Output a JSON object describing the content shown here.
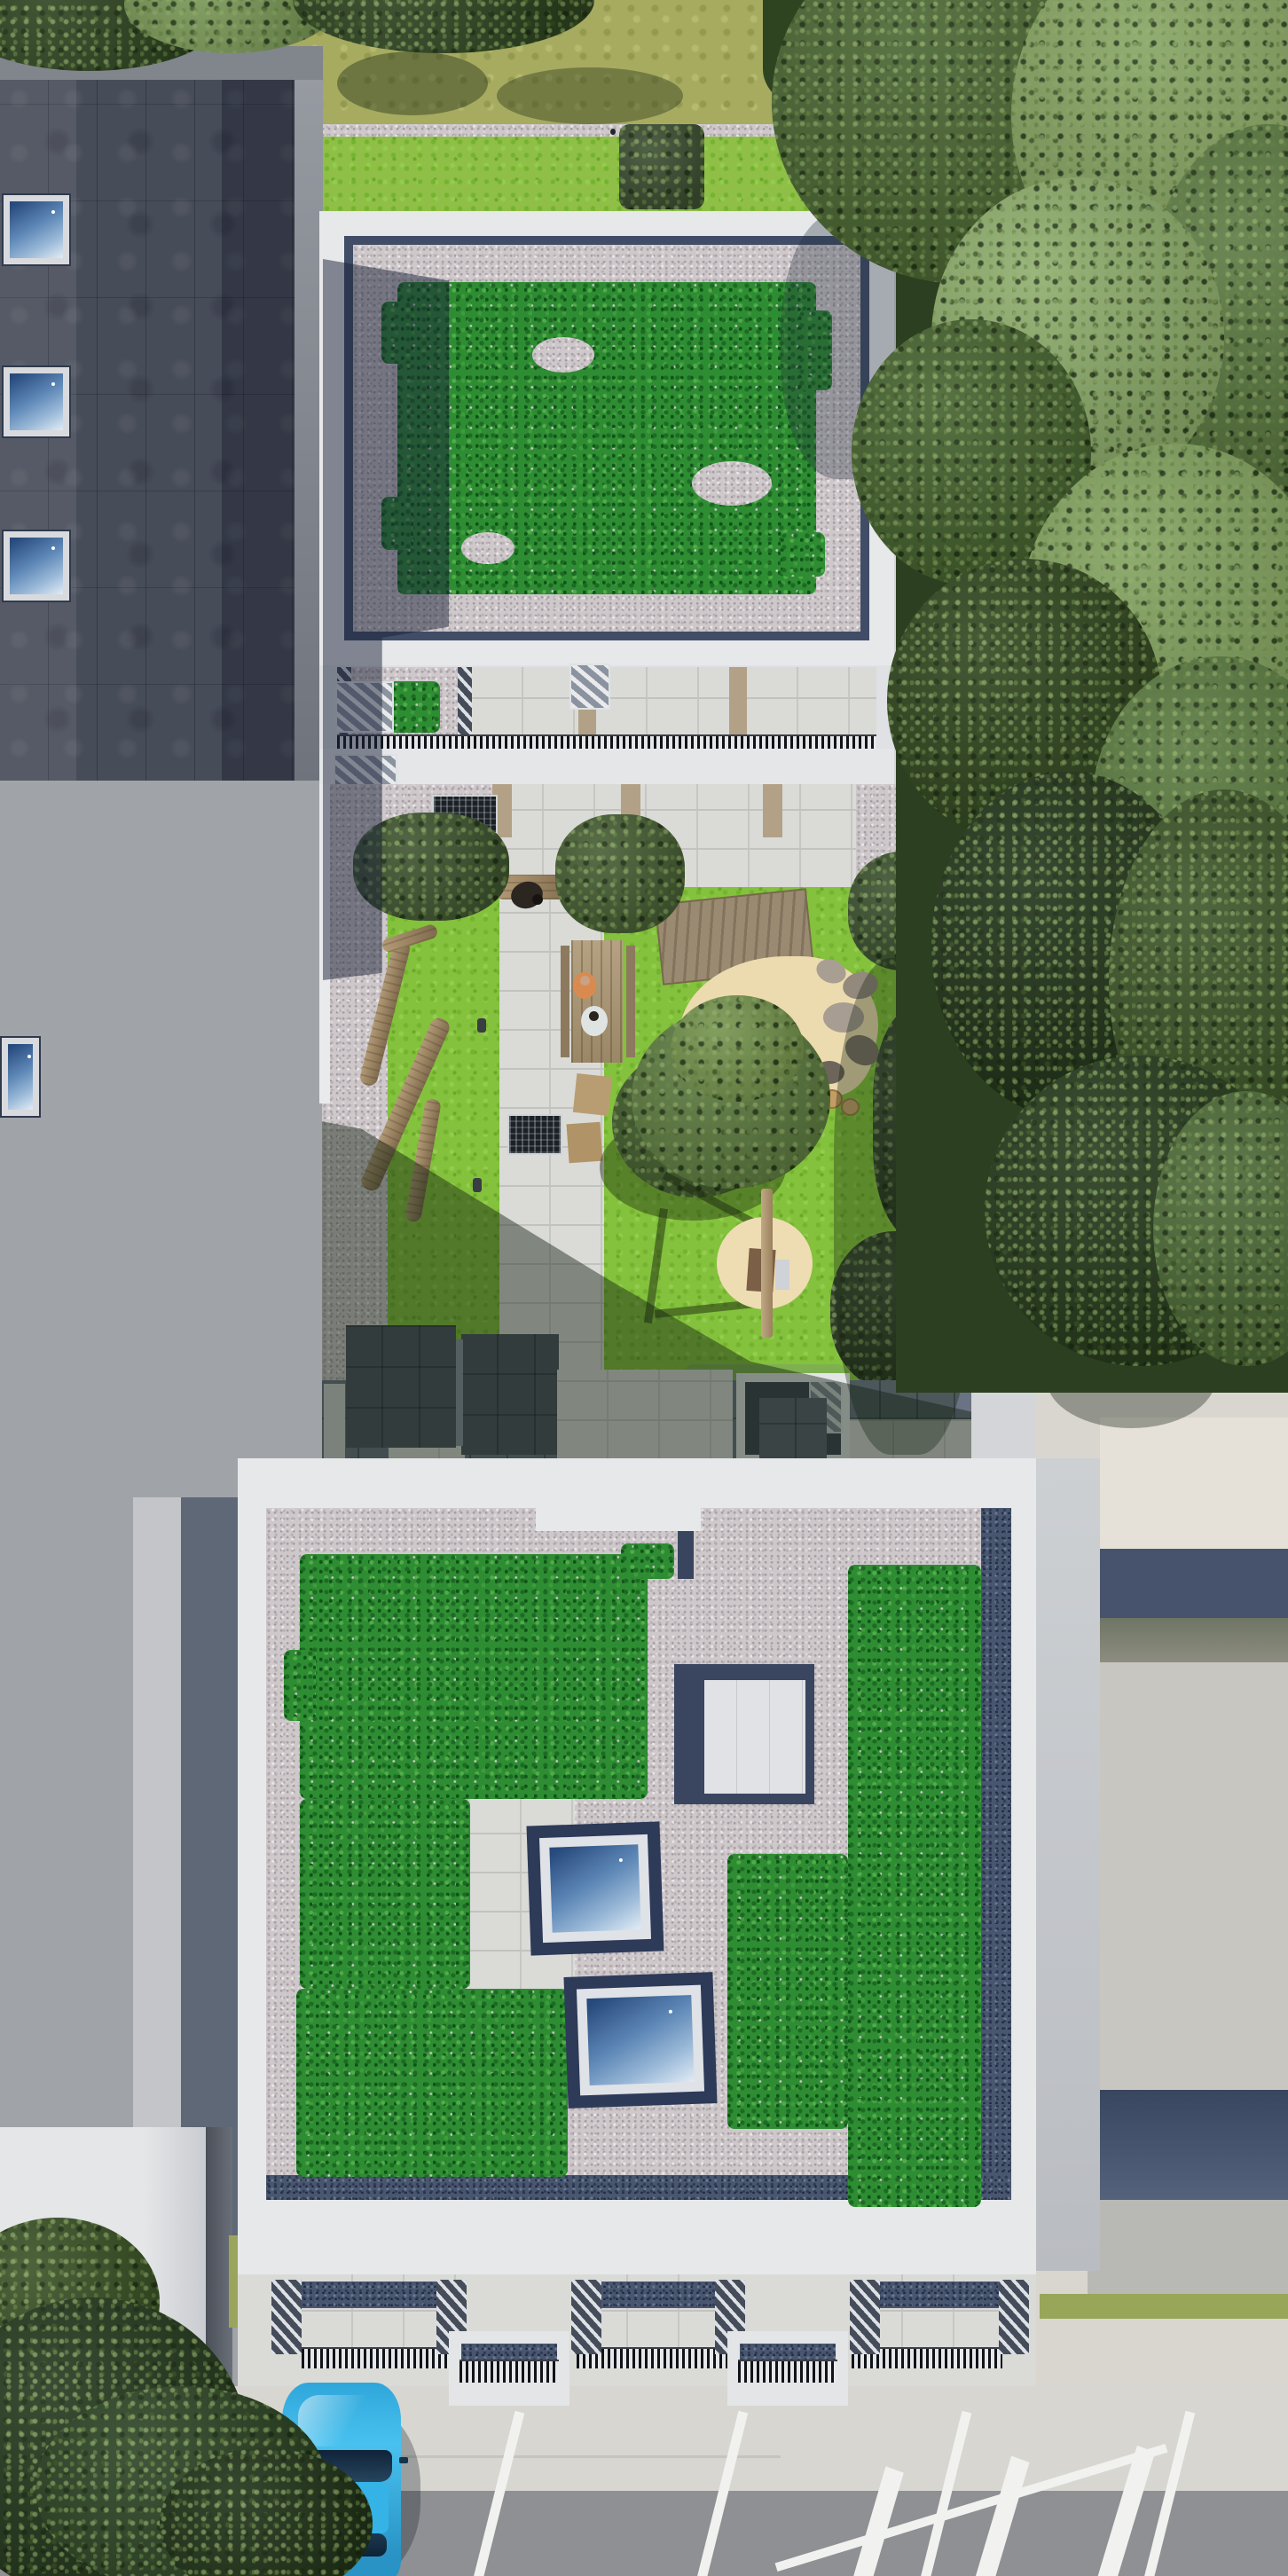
{
  "scene": {
    "title": "Top-down aerial 3D architectural rendering of a residential infill project: two white apartment blocks with sedum green roofs around a landscaped play courtyard, flanked by a dark-roofed neighbour building, mature trees and a parking area",
    "view": "orthographic top-down render, no visible text or UI",
    "no_visible_text": true
  },
  "palette": {
    "base_paving": "#d3d5d8",
    "sidewalk": "#d8d6d1",
    "asphalt": "#8e9093",
    "charcoal_roof": "#474c59",
    "facade_gray": "#9a9da3",
    "parapet_white": "#e6e8ea",
    "gravel_pink": "#cec8cb",
    "gravel_navy": "#49566f",
    "sedum_green": "#2e8d33",
    "lawn_green": "#84c13c",
    "lawn_olive": "#a6ab60",
    "canopy_dark": "#2e4420",
    "canopy_mid": "#4e6b38",
    "canopy_light": "#86a462",
    "shrub_dark": "#3f5530",
    "slab_paving": "#dadbd7",
    "sand": "#ecdbae",
    "wood": "#a08864",
    "skylight_frame": "#dfe2e6",
    "skylight_surround": "#2d3a58",
    "car_blue": "#35b3e6",
    "marking_white": "#f1f2ef",
    "neighbor_cream": "#e6e1d8",
    "neighbor_navy": "#47536c",
    "neighbor_gray": "#c8c6c1",
    "grass_verge": "#98a659",
    "tan_divider": "#b2a187",
    "railing_dark": "#101318"
  },
  "buildings": {
    "left_neighbor": {
      "roof": "dark charcoal standing-seam tiles",
      "skylights_on_dark_roof": 3,
      "skylight_on_lower_wing": 1,
      "lower_wing_roof": "white flat roof, partly under street tree"
    },
    "rear_block": {
      "roof": "extensive sedum green roof with pink gravel margin and navy drainage edge",
      "parapet": "white",
      "south_terraces": "stepped balconies with slatted railings, gravel strips, sedum patch, pale paving, tan dividers, white louvre canopies"
    },
    "front_block": {
      "roof": "pink gravel field with two large L-shaped sedum patches",
      "roof_skylights": 2,
      "roof_hatch_box": 1,
      "inlaid_concrete_walk": 1,
      "south_balconies": "patios with navy gravel strips, striped railings, diagonal privacy screens",
      "protruding_ground_terraces": 2,
      "stair_bulkheads_on_courtyard_side": 2,
      "entrance_canopy": "white frame with louvred top over dark paving"
    },
    "right_neighbor": {
      "roof": "plain warm-gray flat roof with cream section and dark navy bands"
    }
  },
  "courtyard": {
    "lawn": "bright green play lawn",
    "features": [
      "stone slab central path",
      "drain grates",
      "timber balance logs",
      "bollard lights",
      "wooden picnic table with two seated people",
      "seat cushions on lawn",
      "bench with crouching person",
      "timber deck platform",
      "kidney-shaped sand play area edged with boulders and timber rounds",
      "large courtyard tree",
      "swing frame over circular sand pit",
      "shrub groups",
      "clipped box hedge",
      "boundary fence to woodland"
    ],
    "people_count": 4
  },
  "site": {
    "north_garden": [
      "olive rear lawn with tree shadows",
      "narrow gravel path",
      "bright lawn strip",
      "clipped box hedges",
      "small path light"
    ],
    "south_street": [
      "concrete sidewalk",
      "angled parking stalls with white lines",
      "asphalt lane",
      "white hatched road marking",
      "parked cyan car",
      "street tree over car"
    ],
    "east_edge": [
      "mature tree canopies",
      "neighbour roofs",
      "green verge strip"
    ],
    "counts": {
      "parking_stall_lines": 4,
      "hatch_marking_bars": 3,
      "balance_logs": 4,
      "picnic_cushions": 2
    }
  }
}
